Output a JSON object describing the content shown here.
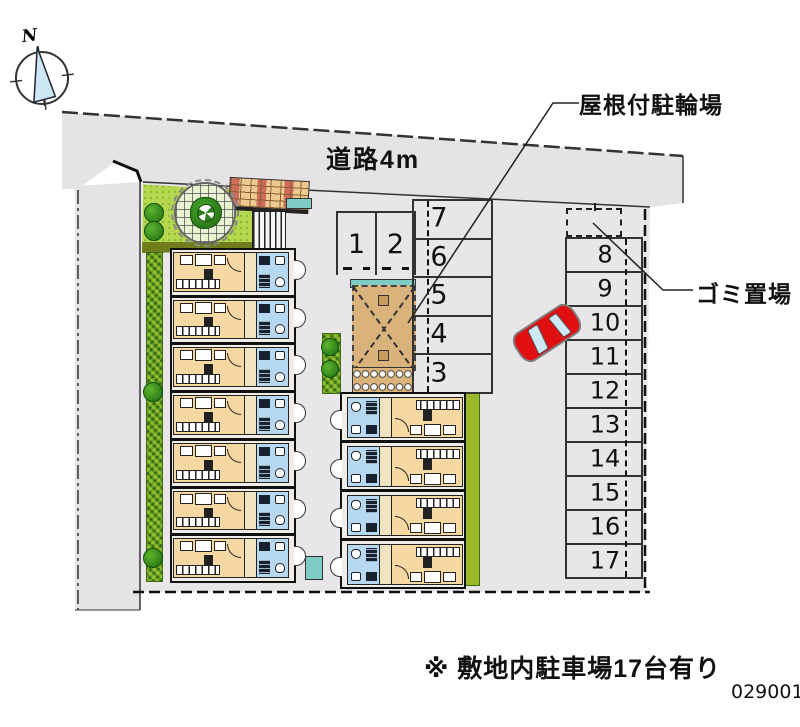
{
  "compass": {
    "label": "N"
  },
  "road": {
    "label": "道路4m"
  },
  "annotations": {
    "bike_parking": "屋根付駐輪場",
    "garbage": "ゴミ置場",
    "note": "※ 敷地内駐車場17台有り",
    "plan_code": "029001"
  },
  "parking": {
    "top_row": [
      "1",
      "2"
    ],
    "middle_column": [
      "7",
      "6",
      "5",
      "4",
      "3"
    ],
    "right_column": [
      "8",
      "9",
      "10",
      "11",
      "12",
      "13",
      "14",
      "15",
      "16",
      "17"
    ],
    "total_spaces": 17
  },
  "buildings": {
    "left": {
      "units": 7
    },
    "center": {
      "units": 4
    }
  },
  "colors": {
    "road": "#e6e3e6",
    "site": "#e8e6e8",
    "room": "#f6d9a2",
    "bath": "#b7d8f1",
    "grass": "#b5d94e",
    "bikeroof": "#d9b27c",
    "teal": "#7fccc4",
    "car": "#e01012",
    "needle": "#cde7f4"
  }
}
